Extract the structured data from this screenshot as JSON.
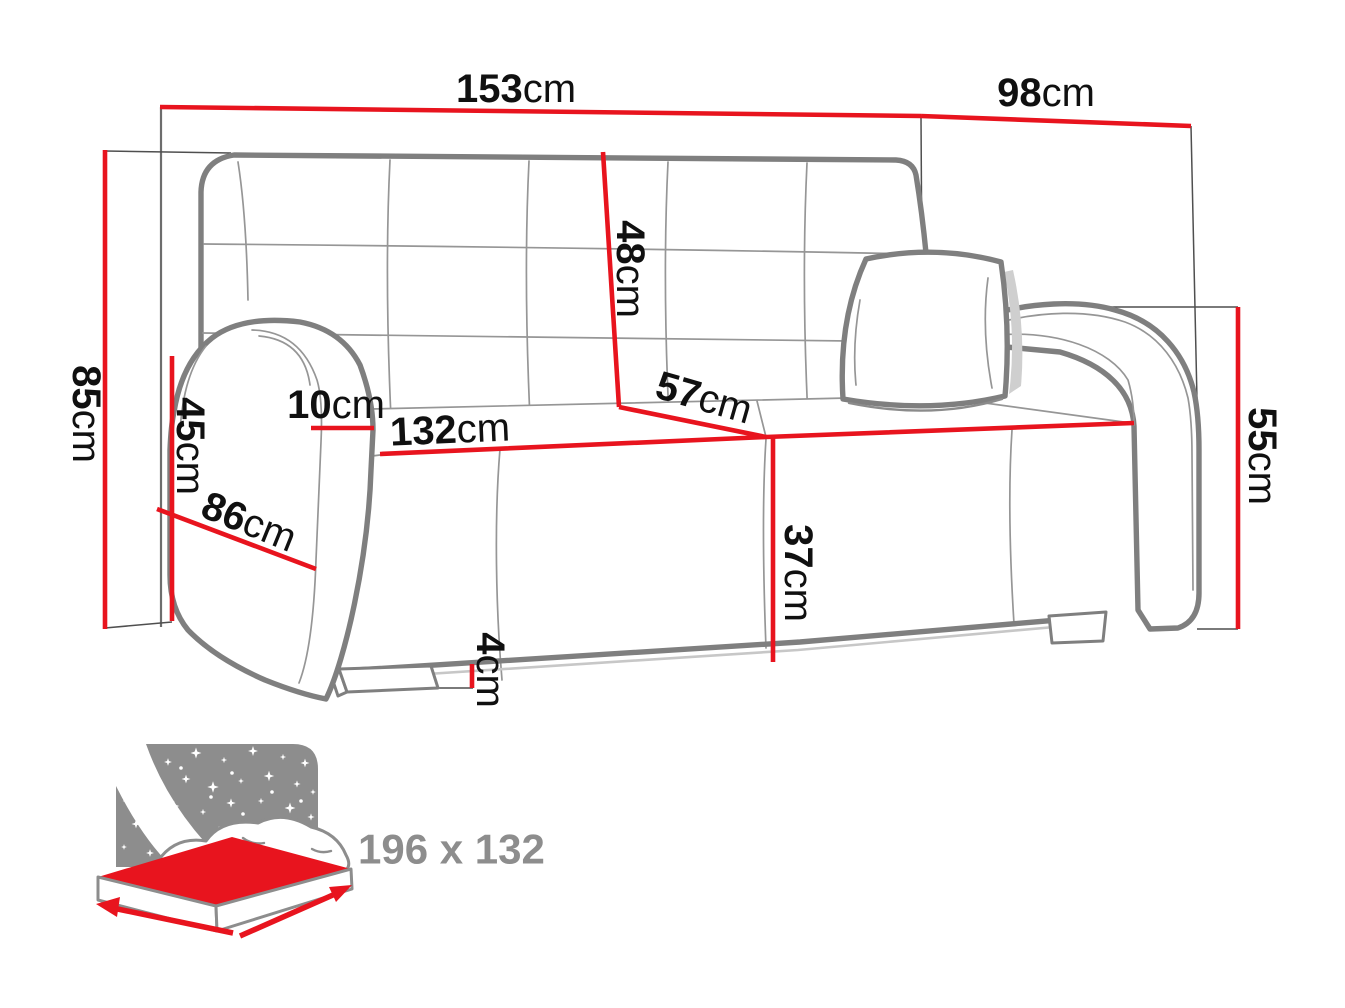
{
  "diagram": {
    "title": "sofa-bed-dimension-diagram",
    "dimensions": {
      "total_width": {
        "value": "153",
        "unit": "cm"
      },
      "total_depth": {
        "value": "98",
        "unit": "cm"
      },
      "total_height": {
        "value": "85",
        "unit": "cm"
      },
      "arm_front_height": {
        "value": "45",
        "unit": "cm"
      },
      "armrest_width": {
        "value": "10",
        "unit": "cm"
      },
      "backrest_height": {
        "value": "48",
        "unit": "cm"
      },
      "seat_width": {
        "value": "132",
        "unit": "cm"
      },
      "seat_depth": {
        "value": "57",
        "unit": "cm"
      },
      "side_depth": {
        "value": "86",
        "unit": "cm"
      },
      "arm_height": {
        "value": "55",
        "unit": "cm"
      },
      "seat_height": {
        "value": "37",
        "unit": "cm"
      },
      "leg_height": {
        "value": "4",
        "unit": "cm"
      }
    },
    "sleeping_area": {
      "label": "196 x 132"
    },
    "colors": {
      "dimension_red": "#e8141e",
      "line_gray": "#7f7f7f",
      "icon_gray": "#8d8d8d",
      "text_black": "#101010"
    }
  }
}
